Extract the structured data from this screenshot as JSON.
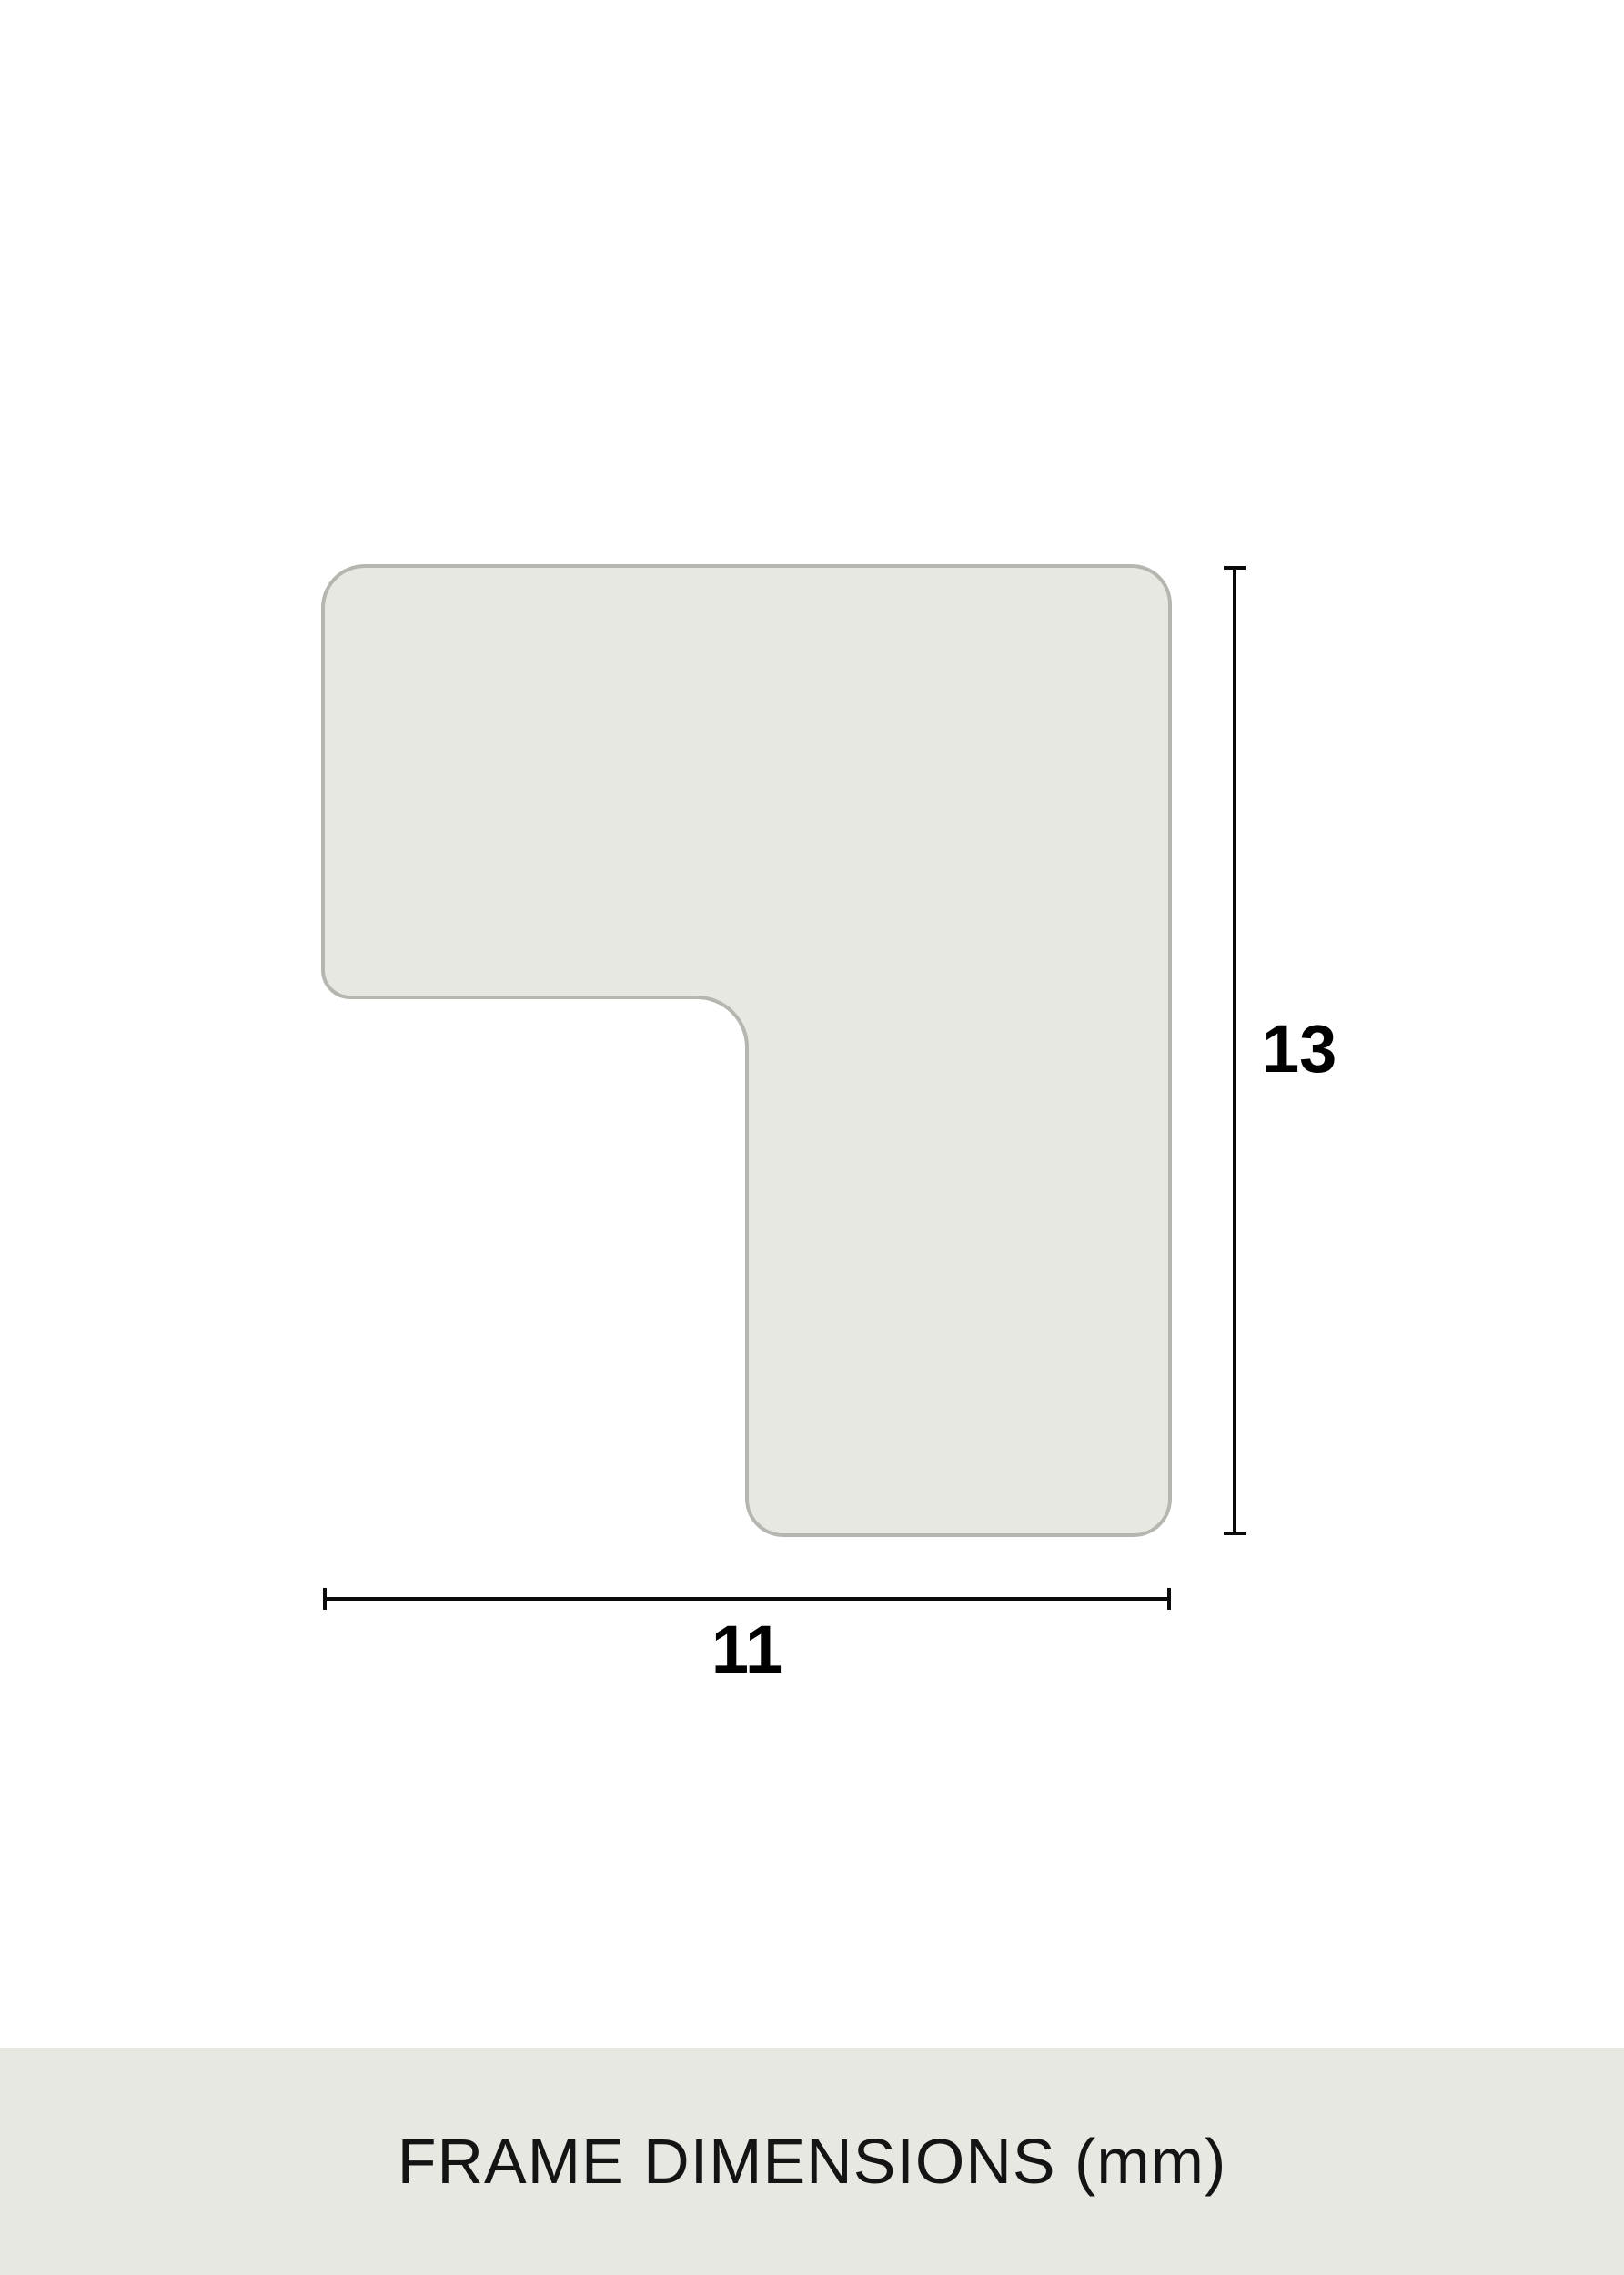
{
  "diagram": {
    "height_label": "13",
    "width_label": "11",
    "colors": {
      "shape_fill": "#e8e8e3",
      "shape_stroke": "#b6b6b1",
      "dimension_line": "#0a0a0a",
      "label_text": "#000000",
      "footer_background": "#e8e8e3",
      "footer_text": "#141414",
      "page_background": "#ffffff"
    }
  },
  "footer": {
    "caption": "FRAME DIMENSIONS (mm)"
  }
}
